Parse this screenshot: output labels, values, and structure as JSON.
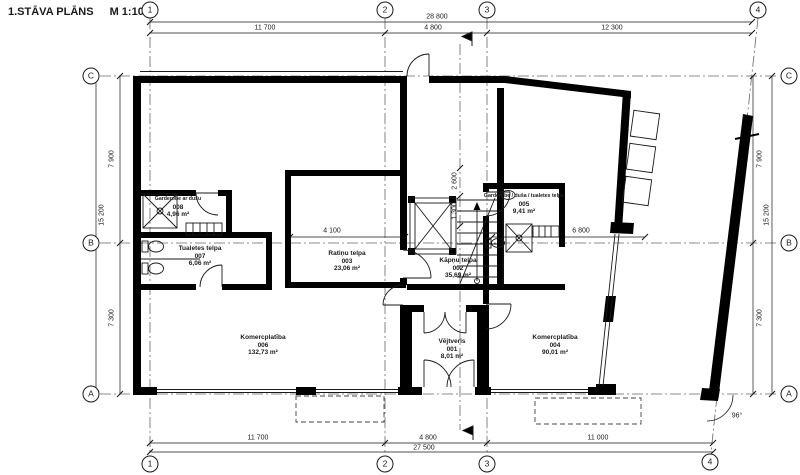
{
  "title": {
    "text": "1.STĀVA PLĀNS",
    "scale": "M 1:100"
  },
  "grid": {
    "cols": [
      "1",
      "2",
      "3",
      "4"
    ],
    "rows": [
      "C",
      "B",
      "A"
    ]
  },
  "dims": {
    "top_total": "28 800",
    "top1": "11 700",
    "top2": "4 800",
    "top3": "12 300",
    "bottom1": "11 700",
    "bottom2": "4 800",
    "bottom3": "11 000",
    "bottom_total": "27 500",
    "side_total": "15 200",
    "side_upper": "7 900",
    "side_lower": "7 300",
    "int_ratinu": "4 100",
    "int_right": "6 800",
    "int_stair_upper": "2 600",
    "int_stair_lower": "1 300",
    "angle": "96°"
  },
  "rooms": [
    {
      "name": "Vējtveris",
      "number": "001",
      "area": "8,01 m²"
    },
    {
      "name": "Kāpņu telpa",
      "number": "002",
      "area": "35,69 m²"
    },
    {
      "name": "Ratiņu telpa",
      "number": "003",
      "area": "23,06 m²"
    },
    {
      "name": "Komercplatība",
      "number": "004",
      "area": "90,01 m²"
    },
    {
      "name": "Garderobe / duša / tualetes telpa",
      "number": "005",
      "area": "9,41 m²"
    },
    {
      "name": "Komercplatība",
      "number": "006",
      "area": "132,73 m²"
    },
    {
      "name": "Tualetes telpa",
      "number": "007",
      "area": "6,06 m²"
    },
    {
      "name": "Garderobe ar dušu",
      "number": "008",
      "area": "4,96 m²"
    }
  ]
}
